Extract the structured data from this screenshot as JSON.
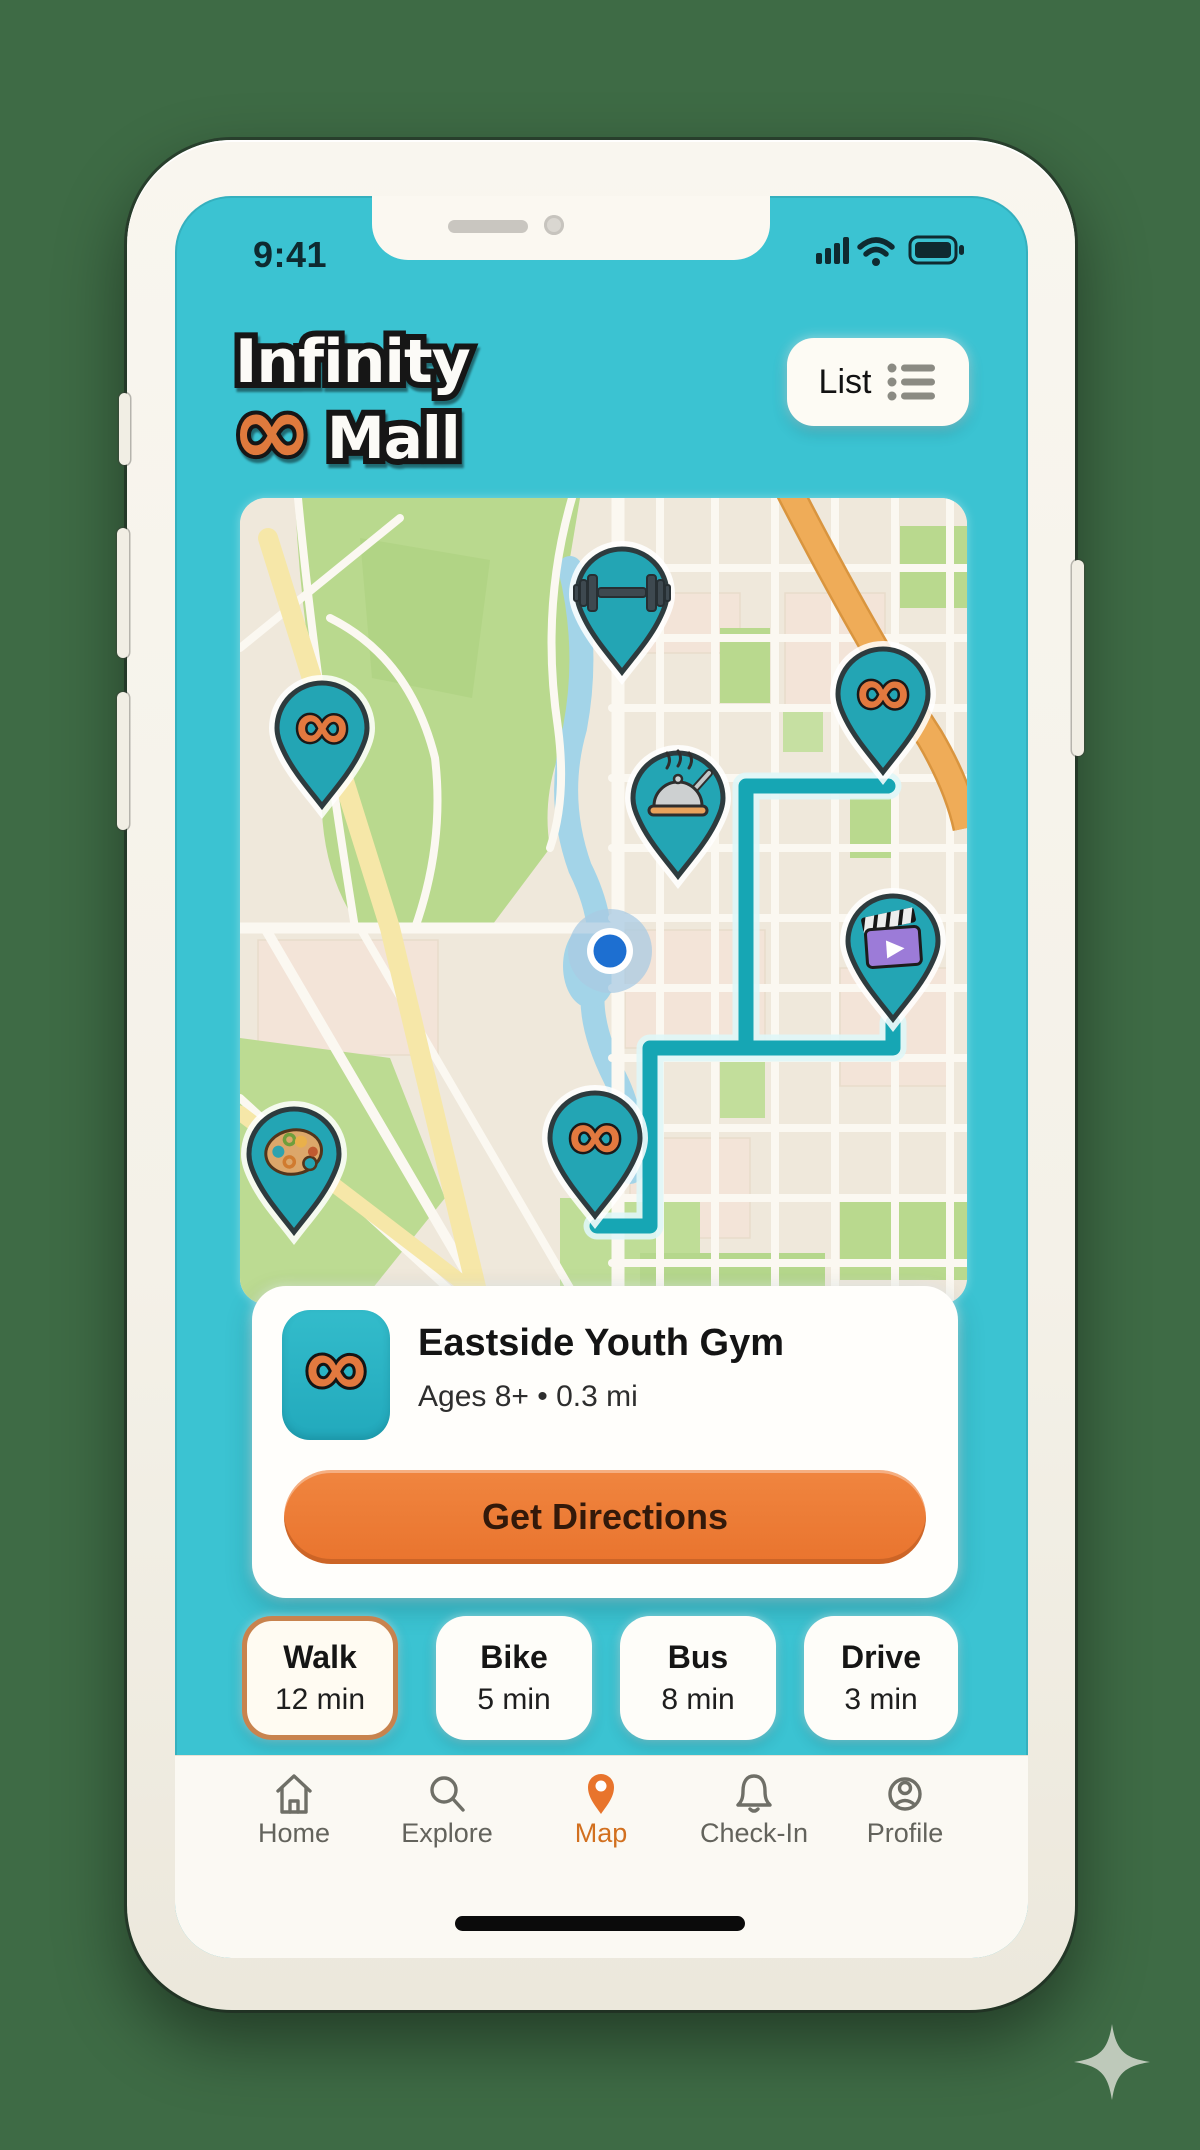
{
  "glyphs": {
    "infinity": "∞",
    "subtitle_dot": "•"
  },
  "status_bar": {
    "time": "9:41",
    "icons": [
      "signal-icon",
      "wifi-icon",
      "battery-icon"
    ]
  },
  "header": {
    "logo_line1": "Infinity",
    "logo_line2": "Mall",
    "list_button_label": "List"
  },
  "map": {
    "pins": [
      {
        "name": "gym-dumbbell-pin",
        "icon": "dumbbell-icon"
      },
      {
        "name": "mall-pin-northeast",
        "icon": "infinity-icon"
      },
      {
        "name": "mall-pin-west",
        "icon": "infinity-icon"
      },
      {
        "name": "dining-pin",
        "icon": "dining-cloche-icon"
      },
      {
        "name": "cinema-pin",
        "icon": "clapperboard-icon"
      },
      {
        "name": "mall-pin-south",
        "icon": "infinity-icon"
      },
      {
        "name": "art-studio-pin",
        "icon": "palette-icon"
      }
    ],
    "user_location": "current-location-dot",
    "route": "teal-route-line"
  },
  "card": {
    "title": "Eastside Youth Gym",
    "subtitle": "Ages 8+ • 0.3 mi",
    "cta_label": "Get Directions",
    "tile_icon": "infinity-icon"
  },
  "travel_modes": [
    {
      "label": "Walk",
      "time": "12 min",
      "selected": true
    },
    {
      "label": "Bike",
      "time": "5 min",
      "selected": false
    },
    {
      "label": "Bus",
      "time": "8 min",
      "selected": false
    },
    {
      "label": "Drive",
      "time": "3 min",
      "selected": false
    }
  ],
  "tab_bar": {
    "items": [
      {
        "label": "Home",
        "icon": "home-icon",
        "active": false
      },
      {
        "label": "Explore",
        "icon": "search-icon",
        "active": false
      },
      {
        "label": "Map",
        "icon": "map-pin-icon",
        "active": true
      },
      {
        "label": "Check-In",
        "icon": "bell-icon",
        "active": false
      },
      {
        "label": "Profile",
        "icon": "profile-icon",
        "active": false
      }
    ]
  },
  "colors": {
    "background_green": "#3E6B45",
    "app_teal": "#3BC3D2",
    "pin_teal": "#23A5B4",
    "route_teal": "#16A6B4",
    "accent_orange": "#ED7C3B",
    "logo_orange": "#DF7A3C",
    "selected_chip_border": "#C8834E",
    "map_cream": "#EFE8DB",
    "park_green": "#B9D98E",
    "water_blue": "#A3D4E8",
    "road_yellow": "#F6E7A8",
    "road_orange": "#EFAC58"
  }
}
